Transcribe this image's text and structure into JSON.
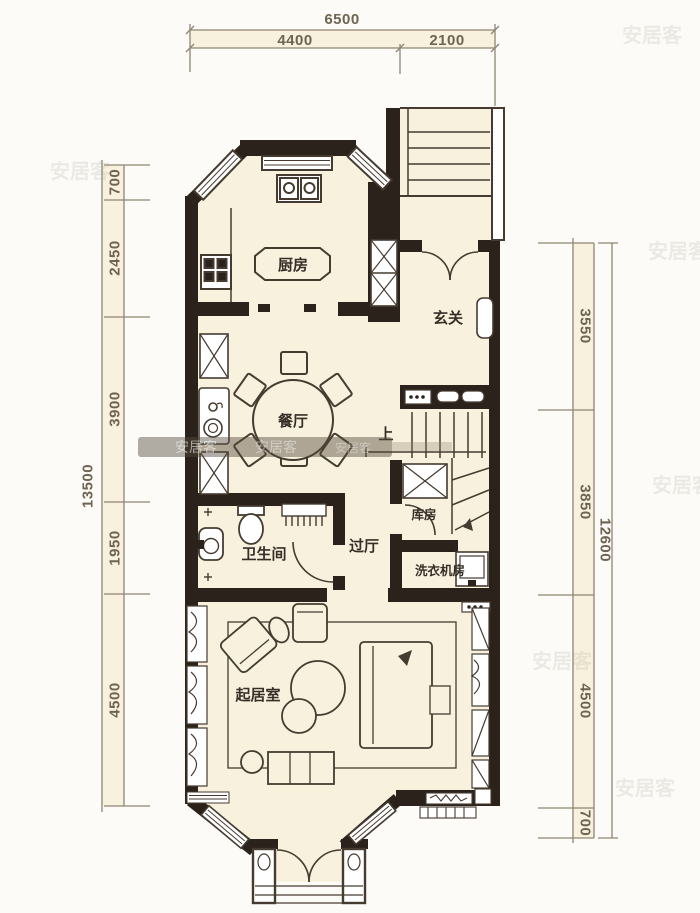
{
  "plan": {
    "colors": {
      "floor": "#f8f1dd",
      "wall": "#2b221b",
      "furniture_line": "#453b31",
      "dim_line": "#8e8674",
      "dim_text": "#6e6452",
      "room_text": "#362f27",
      "watermark": "#9a9383"
    },
    "rooms": {
      "kitchen": "厨房",
      "foyer": "玄关",
      "dining": "餐厅",
      "storage": "库房",
      "bathroom": "卫生间",
      "hall": "过厅",
      "laundry": "洗衣机房",
      "living": "起居室",
      "stairs_up": "上"
    },
    "dimensions": {
      "top": {
        "total": "6500",
        "segments": [
          "4400",
          "2100"
        ]
      },
      "left": {
        "total": "13500",
        "segments": [
          "700",
          "2450",
          "3900",
          "1950",
          "4500"
        ]
      },
      "right": {
        "total": "12600",
        "segments": [
          "3550",
          "3850",
          "4500",
          "700"
        ]
      }
    },
    "watermark": {
      "text": "安居客"
    }
  }
}
